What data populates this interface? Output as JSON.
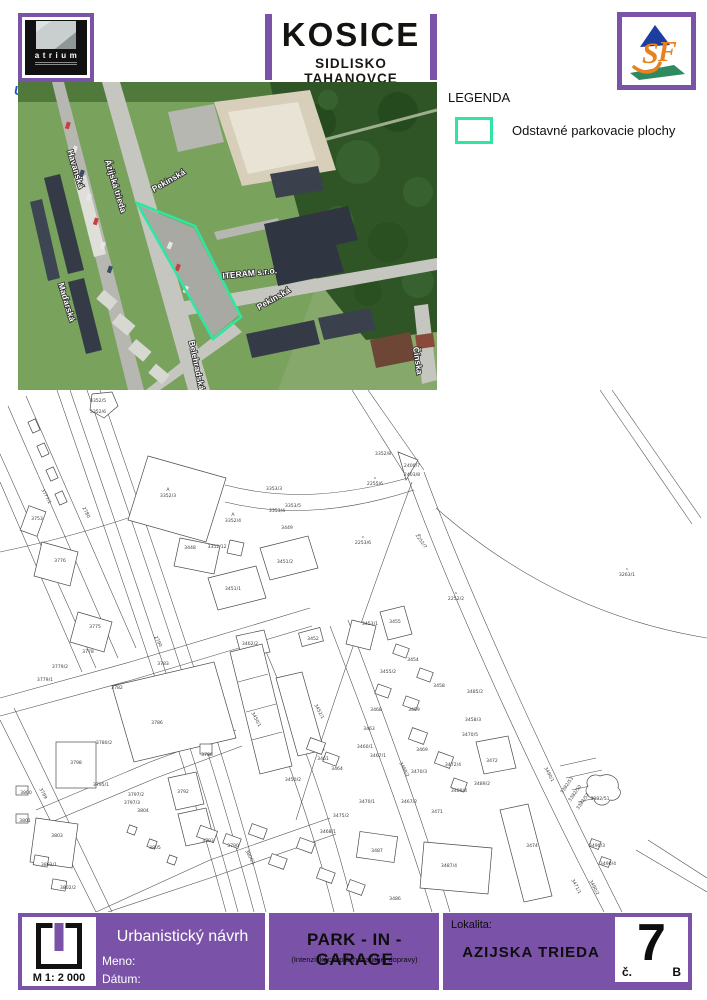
{
  "colors": {
    "purple": "#7a52a8",
    "legend_green": "#2ee6a0"
  },
  "header": {
    "atrium_name": "atrium",
    "uzemneplany_name": "UzemnePlany",
    "uzemneplany_tld": ".sk",
    "title": "KOSICE",
    "subtitle": "SIDLISKO TAHANOVCE",
    "svf_letters": {
      "s": "S",
      "f": "F"
    }
  },
  "legend": {
    "title": "LEGENDA",
    "items": [
      {
        "label": "Odstavné parkovacie plochy",
        "color": "#2ee6a0"
      }
    ]
  },
  "aerial": {
    "street_labels": [
      {
        "text": "Havanská",
        "x": 55,
        "y": 88,
        "rot": 73
      },
      {
        "text": "Ázijská trieda",
        "x": 95,
        "y": 105,
        "rot": 73
      },
      {
        "text": "Pekinská",
        "x": 152,
        "y": 101,
        "rot": -30
      },
      {
        "text": "ITERAM s.r.o.",
        "x": 232,
        "y": 194,
        "rot": -6
      },
      {
        "text": "Pekinská",
        "x": 257,
        "y": 219,
        "rot": -30
      },
      {
        "text": "Maďarská",
        "x": 46,
        "y": 221,
        "rot": 73
      },
      {
        "text": "Belehradská",
        "x": 176,
        "y": 284,
        "rot": 78
      },
      {
        "text": "Čínska",
        "x": 397,
        "y": 279,
        "rot": 82
      }
    ]
  },
  "map": {
    "parcels": [
      {
        "t": "3352/5",
        "x": 98,
        "y": 12
      },
      {
        "t": "3352/6",
        "x": 98,
        "y": 23
      },
      {
        "t": "3352/3",
        "x": 168,
        "y": 107,
        "m": "A"
      },
      {
        "t": "3352/4",
        "x": 233,
        "y": 132,
        "m": "A"
      },
      {
        "t": "3353/3",
        "x": 274,
        "y": 100
      },
      {
        "t": "3353/5",
        "x": 293,
        "y": 117
      },
      {
        "t": "3353/4",
        "x": 277,
        "y": 122
      },
      {
        "t": "3449",
        "x": 287,
        "y": 139
      },
      {
        "t": "3448",
        "x": 190,
        "y": 159
      },
      {
        "t": "3352/12",
        "x": 217,
        "y": 158
      },
      {
        "t": "3352/8",
        "x": 383,
        "y": 65
      },
      {
        "t": "2400/7",
        "x": 412,
        "y": 77
      },
      {
        "t": "2403/8",
        "x": 412,
        "y": 86
      },
      {
        "t": "2255/6",
        "x": 375,
        "y": 95,
        "m": "^"
      },
      {
        "t": "2253/6",
        "x": 363,
        "y": 154,
        "m": "^"
      },
      {
        "t": "2252/7",
        "x": 420,
        "y": 152,
        "m": "^",
        "r": 55
      },
      {
        "t": "2252/2",
        "x": 456,
        "y": 210,
        "m": "^"
      },
      {
        "t": "3263/1",
        "x": 627,
        "y": 186,
        "m": "^"
      },
      {
        "t": "3777/1",
        "x": 45,
        "y": 107,
        "r": 62
      },
      {
        "t": "2780",
        "x": 85,
        "y": 123,
        "r": 62
      },
      {
        "t": "3753",
        "x": 37,
        "y": 130
      },
      {
        "t": "3776",
        "x": 60,
        "y": 172
      },
      {
        "t": "3775",
        "x": 95,
        "y": 238
      },
      {
        "t": "2790",
        "x": 157,
        "y": 252,
        "r": 62
      },
      {
        "t": "3778",
        "x": 88,
        "y": 263
      },
      {
        "t": "3779/2",
        "x": 60,
        "y": 278
      },
      {
        "t": "3779/1",
        "x": 45,
        "y": 291
      },
      {
        "t": "3783",
        "x": 163,
        "y": 275
      },
      {
        "t": "3782",
        "x": 117,
        "y": 299
      },
      {
        "t": "3786",
        "x": 157,
        "y": 334
      },
      {
        "t": "3780/2",
        "x": 104,
        "y": 354
      },
      {
        "t": "3798",
        "x": 76,
        "y": 374
      },
      {
        "t": "3795/1",
        "x": 101,
        "y": 396
      },
      {
        "t": "3800",
        "x": 26,
        "y": 404
      },
      {
        "t": "3799",
        "x": 42,
        "y": 404,
        "r": 62
      },
      {
        "t": "3801",
        "x": 25,
        "y": 432
      },
      {
        "t": "3803",
        "x": 57,
        "y": 447
      },
      {
        "t": "3802/1",
        "x": 49,
        "y": 476
      },
      {
        "t": "3802/2",
        "x": 68,
        "y": 499
      },
      {
        "t": "3797/2",
        "x": 136,
        "y": 406
      },
      {
        "t": "3797/3",
        "x": 132,
        "y": 414
      },
      {
        "t": "3804",
        "x": 143,
        "y": 422
      },
      {
        "t": "3792",
        "x": 183,
        "y": 403
      },
      {
        "t": "3788",
        "x": 207,
        "y": 366
      },
      {
        "t": "3793",
        "x": 208,
        "y": 452
      },
      {
        "t": "3790",
        "x": 233,
        "y": 457
      },
      {
        "t": "3805",
        "x": 155,
        "y": 459
      },
      {
        "t": "3806/1",
        "x": 249,
        "y": 468,
        "r": 62
      },
      {
        "t": "3451/1",
        "x": 233,
        "y": 200
      },
      {
        "t": "3451/2",
        "x": 285,
        "y": 173
      },
      {
        "t": "3462/2",
        "x": 250,
        "y": 255
      },
      {
        "t": "3452",
        "x": 313,
        "y": 250
      },
      {
        "t": "3450/1",
        "x": 255,
        "y": 330,
        "r": 62
      },
      {
        "t": "3450/2",
        "x": 293,
        "y": 391
      },
      {
        "t": "3452/1",
        "x": 318,
        "y": 322,
        "r": 62
      },
      {
        "t": "3461",
        "x": 323,
        "y": 370
      },
      {
        "t": "3464",
        "x": 337,
        "y": 380
      },
      {
        "t": "3475/2",
        "x": 341,
        "y": 427
      },
      {
        "t": "3468/1",
        "x": 328,
        "y": 443
      },
      {
        "t": "3453/1",
        "x": 370,
        "y": 235
      },
      {
        "t": "3455",
        "x": 395,
        "y": 233
      },
      {
        "t": "3455/2",
        "x": 388,
        "y": 283
      },
      {
        "t": "3454",
        "x": 413,
        "y": 271
      },
      {
        "t": "3458",
        "x": 439,
        "y": 297
      },
      {
        "t": "3459",
        "x": 414,
        "y": 321
      },
      {
        "t": "3468",
        "x": 376,
        "y": 321
      },
      {
        "t": "3463",
        "x": 369,
        "y": 340
      },
      {
        "t": "3460/1",
        "x": 365,
        "y": 358
      },
      {
        "t": "3467/1",
        "x": 378,
        "y": 367
      },
      {
        "t": "3485/2",
        "x": 475,
        "y": 303
      },
      {
        "t": "3458/3",
        "x": 473,
        "y": 331
      },
      {
        "t": "3470/5",
        "x": 470,
        "y": 346
      },
      {
        "t": "3469",
        "x": 422,
        "y": 361
      },
      {
        "t": "3470/3",
        "x": 419,
        "y": 383
      },
      {
        "t": "3468/2",
        "x": 403,
        "y": 380,
        "r": 62
      },
      {
        "t": "3472/4",
        "x": 453,
        "y": 376
      },
      {
        "t": "3472",
        "x": 492,
        "y": 372
      },
      {
        "t": "3489/2",
        "x": 482,
        "y": 395
      },
      {
        "t": "3489/4",
        "x": 459,
        "y": 402
      },
      {
        "t": "3470/1",
        "x": 367,
        "y": 413
      },
      {
        "t": "3467/2",
        "x": 409,
        "y": 413
      },
      {
        "t": "3471",
        "x": 437,
        "y": 423
      },
      {
        "t": "3487",
        "x": 377,
        "y": 462
      },
      {
        "t": "3487/4",
        "x": 449,
        "y": 477
      },
      {
        "t": "3486",
        "x": 395,
        "y": 510
      },
      {
        "t": "3474",
        "x": 532,
        "y": 457
      },
      {
        "t": "3490/1",
        "x": 548,
        "y": 385,
        "r": 62
      },
      {
        "t": "3490/3",
        "x": 597,
        "y": 457
      },
      {
        "t": "3490/4",
        "x": 608,
        "y": 475
      },
      {
        "t": "3382/53",
        "x": 568,
        "y": 396,
        "r": -55
      },
      {
        "t": "3382/50",
        "x": 576,
        "y": 404,
        "r": -55
      },
      {
        "t": "3382/52",
        "x": 584,
        "y": 412,
        "r": -55
      },
      {
        "t": "3382/51",
        "x": 600,
        "y": 410
      },
      {
        "t": "3471/1",
        "x": 575,
        "y": 497,
        "r": 62
      },
      {
        "t": "3490/2",
        "x": 593,
        "y": 498,
        "r": 62
      }
    ]
  },
  "footer": {
    "scale": "M 1: 2 000",
    "project_type": "Urbanistický návrh",
    "name_label": "Meno:",
    "date_label": "Dátum:",
    "project_title": "PARK - IN - GARAGE",
    "project_subtitle": "(Intenzifikácia plôch statickej dopravy)",
    "locality_label": "Lokalita:",
    "locality": "AZIJSKA TRIEDA",
    "sheet_prefix": "č.",
    "sheet_number": "7",
    "sheet_suffix": "B"
  }
}
